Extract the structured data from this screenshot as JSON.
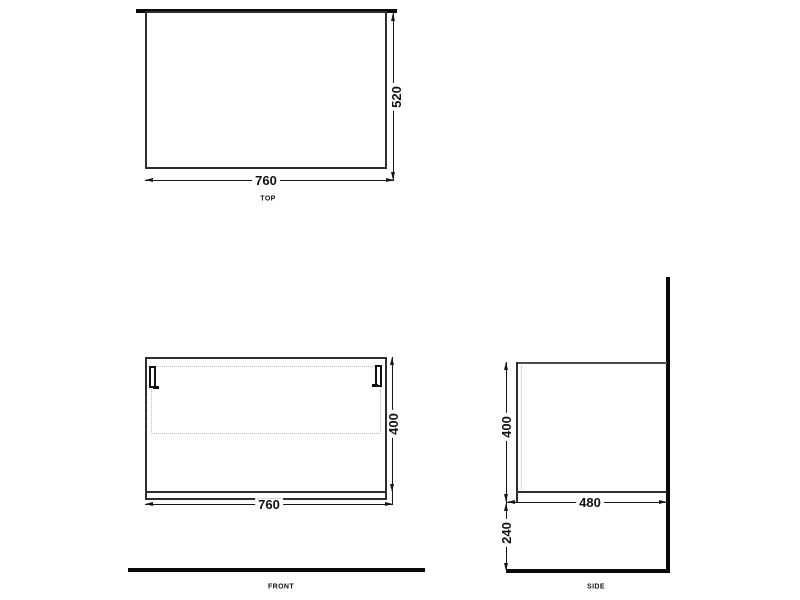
{
  "drawing": {
    "top": {
      "label": "TOP",
      "width": "760",
      "depth": "520"
    },
    "front": {
      "label": "FRONT",
      "width": "760",
      "height": "400"
    },
    "side": {
      "label": "SIDE",
      "depth": "480",
      "height": "400",
      "height_from_floor": "240"
    },
    "colors": {
      "outline": "#2e2e2e",
      "thick_line": "#0a0a0a",
      "dim_line": "#161616",
      "dashed_line": "#bdbdbd",
      "text": "#111111",
      "background": "#ffffff"
    }
  }
}
